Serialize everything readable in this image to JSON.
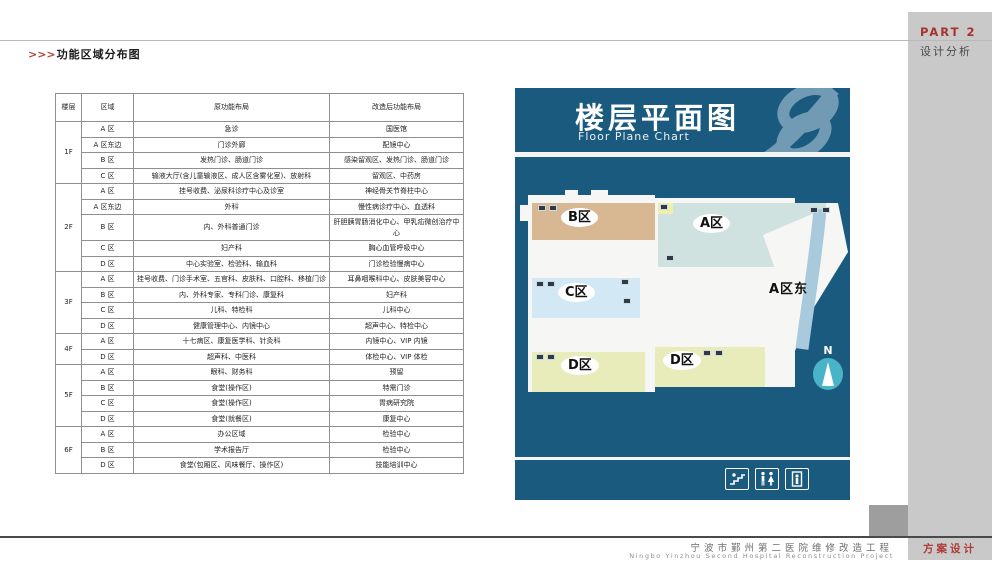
{
  "header": {
    "arrows": ">>>",
    "title": "功能区域分布图"
  },
  "sidebar": {
    "part": "PART 2",
    "section": "设计分析"
  },
  "footer": {
    "project_cn": "宁波市鄞州第二医院维修改造工程",
    "project_en": "Ningbo Yinzhou Second Hospital Reconstruction Project",
    "tag": "方案设计"
  },
  "panel": {
    "title": "楼层平面图",
    "subtitle": "Floor Plane Chart",
    "compass": "N"
  },
  "map": {
    "east_label": "A区东",
    "blocks": [
      {
        "label": "B区",
        "color": "#d8b893"
      },
      {
        "label": "A区",
        "color": "#cfe2df"
      },
      {
        "label": "C区",
        "color": "#d3e8f5"
      },
      {
        "label": "D区",
        "color": "#e8ecba"
      },
      {
        "label": "D区",
        "color": "#e8ecba"
      }
    ],
    "legend_icons": [
      "stairs-icon",
      "restroom-icon",
      "elevator-icon"
    ]
  },
  "colors": {
    "panel_blue": "#1a5a7e",
    "accent_red": "#a8332e",
    "sidebar_gray": "#c9c9c9",
    "compass_teal": "#49b4c8",
    "east_strip": "#a9c9dd"
  },
  "table": {
    "headers": [
      "楼层",
      "区域",
      "原功能布局",
      "改造后功能布局"
    ],
    "groups": [
      {
        "floor": "1F",
        "rows": [
          [
            "A 区",
            "急诊",
            "国医馆"
          ],
          [
            "A 区东边",
            "门诊外廊",
            "配镜中心"
          ],
          [
            "B 区",
            "发热门诊、肠道门诊",
            "感染留观区、发热门诊、肠道门诊"
          ],
          [
            "C 区",
            "输液大厅(含儿童输液区、成人区含雾化室)、放射科",
            "留观区、中药房"
          ]
        ]
      },
      {
        "floor": "2F",
        "rows": [
          [
            "A 区",
            "挂号收费、泌尿科诊疗中心及诊室",
            "神经骨关节脊柱中心"
          ],
          [
            "A 区东边",
            "外科",
            "慢性病诊疗中心、血透科"
          ],
          [
            "B 区",
            "内、外科普通门诊",
            "肝胆胰胃肠消化中心、甲乳疝微创治疗中心"
          ],
          [
            "C 区",
            "妇产科",
            "胸心血管呼吸中心"
          ],
          [
            "D 区",
            "中心实验室、检验科、输血科",
            "门诊检验慢病中心"
          ]
        ]
      },
      {
        "floor": "3F",
        "rows": [
          [
            "A 区",
            "挂号收费、门诊手术室、五官科、皮肤科、口腔科、移植门诊",
            "耳鼻咽喉科中心、皮肤美容中心"
          ],
          [
            "B 区",
            "内、外科专家、专科门诊、康复科",
            "妇产科"
          ],
          [
            "C 区",
            "儿科、特检科",
            "儿科中心"
          ],
          [
            "D 区",
            "健康管理中心、内镜中心",
            "超声中心、特检中心"
          ]
        ]
      },
      {
        "floor": "4F",
        "rows": [
          [
            "A 区",
            "十七病区、康复医学科、针灸科",
            "内镜中心、VIP 内镜"
          ],
          [
            "D 区",
            "超声科、中医科",
            "体检中心、VIP 体检"
          ]
        ]
      },
      {
        "floor": "5F",
        "rows": [
          [
            "A 区",
            "眼科、财务科",
            "预留"
          ],
          [
            "B 区",
            "食堂(操作区)",
            "特需门诊"
          ],
          [
            "C 区",
            "食堂(操作区)",
            "胃病研究院"
          ],
          [
            "D 区",
            "食堂(就餐区)",
            "康复中心"
          ]
        ]
      },
      {
        "floor": "6F",
        "rows": [
          [
            "A 区",
            "办公区域",
            "检验中心"
          ],
          [
            "B 区",
            "学术报告厅",
            "检验中心"
          ],
          [
            "D 区",
            "食堂(包厢区、风味餐厅、操作区)",
            "技能培训中心"
          ]
        ]
      }
    ]
  }
}
